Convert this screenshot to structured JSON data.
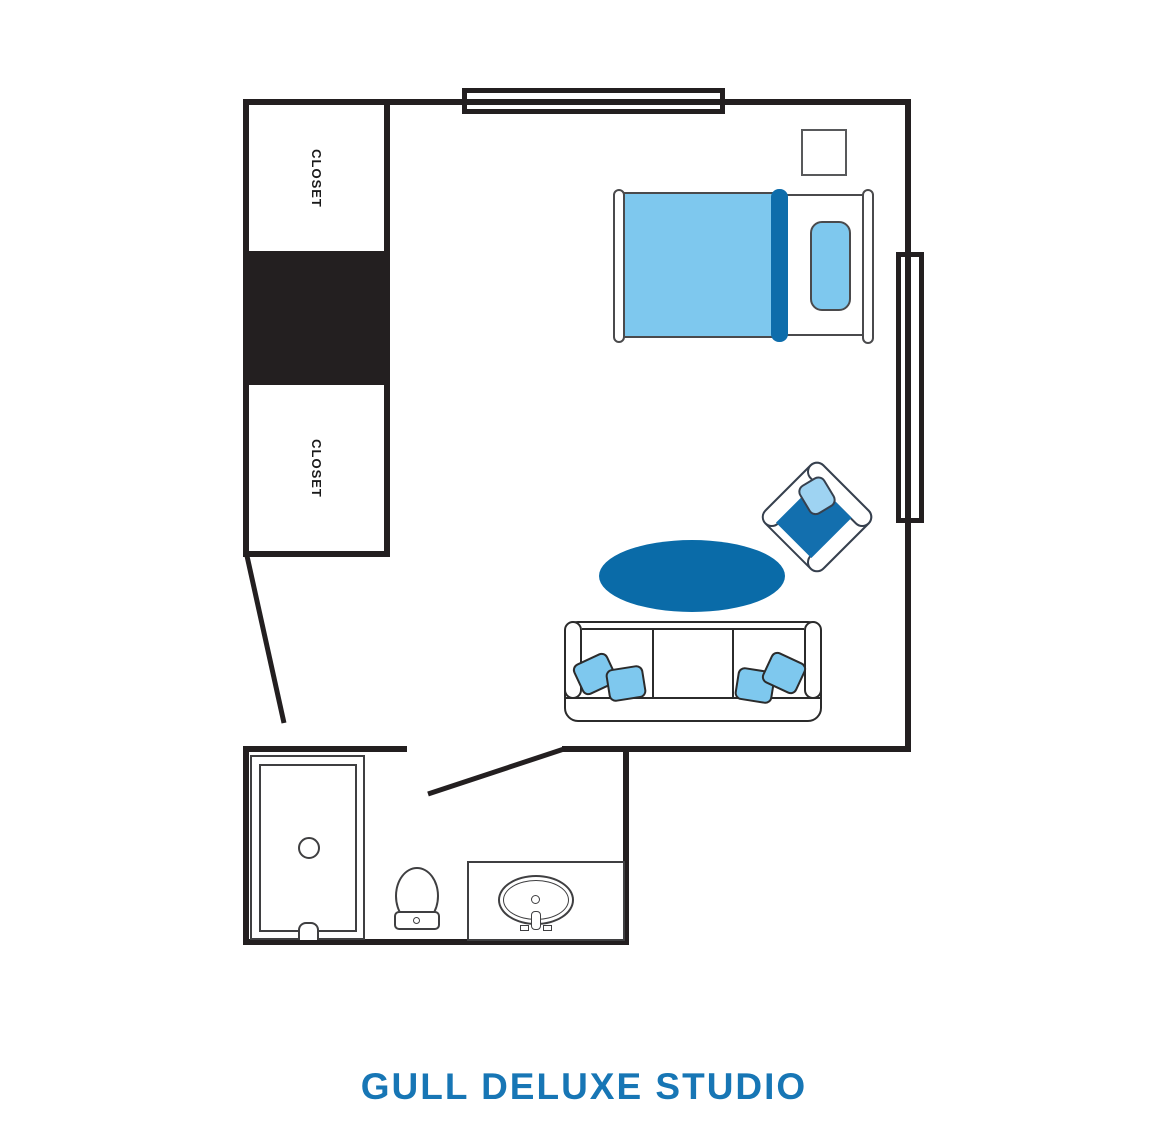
{
  "title": {
    "text": "GULL DELUXE STUDIO"
  },
  "labels": {
    "closet_upper": "CLOSET",
    "closet_lower": "CLOSET"
  },
  "palette": {
    "wall_black": "#231f20",
    "furniture_outline_gray": "#4a4a4c",
    "fixture_outline_gray": "#3f3f41",
    "chair_outline": "#36404e",
    "light_blue": "#7ec8ee",
    "chair_pillow_blue": "#9ed3f2",
    "dark_blue": "#0a6ba8",
    "bed_fold_blue": "#0e6dab",
    "chair_seat_blue": "#136fae",
    "title_blue": "#1776b5"
  }
}
